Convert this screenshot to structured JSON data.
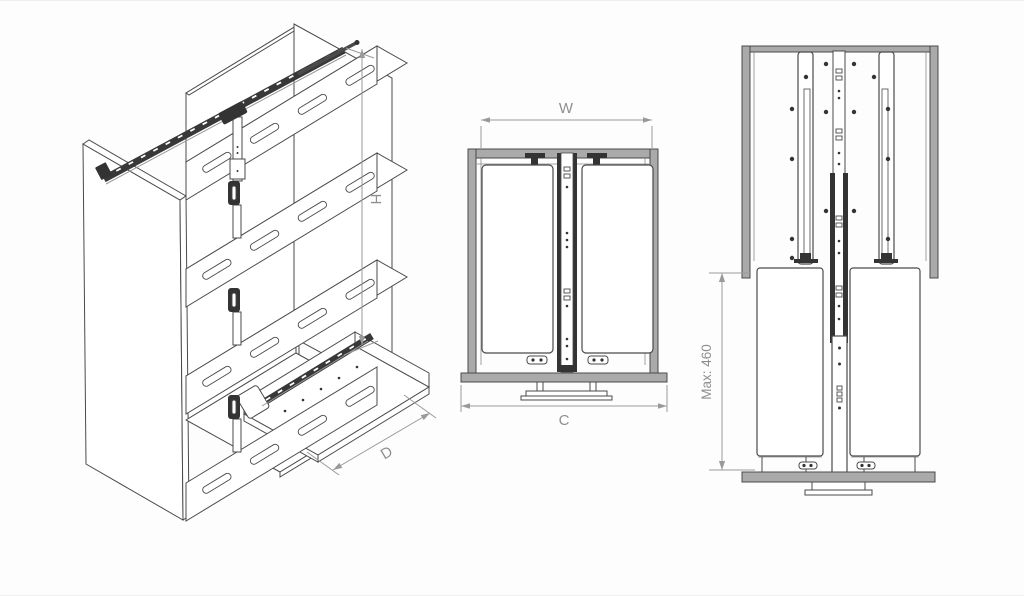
{
  "colors": {
    "background": "#fdfdfd",
    "line": "#4a4a4a",
    "dark": "#333333",
    "panel_gray": "#aaaaaa",
    "dim_line": "#9a9a9a",
    "label_text": "#8f8f8f",
    "white": "#ffffff"
  },
  "views": {
    "isometric": {
      "labels": {
        "height": "H",
        "depth": "D"
      }
    },
    "plan": {
      "labels": {
        "inner_width": "W",
        "overall_width": "C"
      }
    },
    "front": {
      "labels": {
        "max_drop": "Max: 460"
      }
    }
  }
}
